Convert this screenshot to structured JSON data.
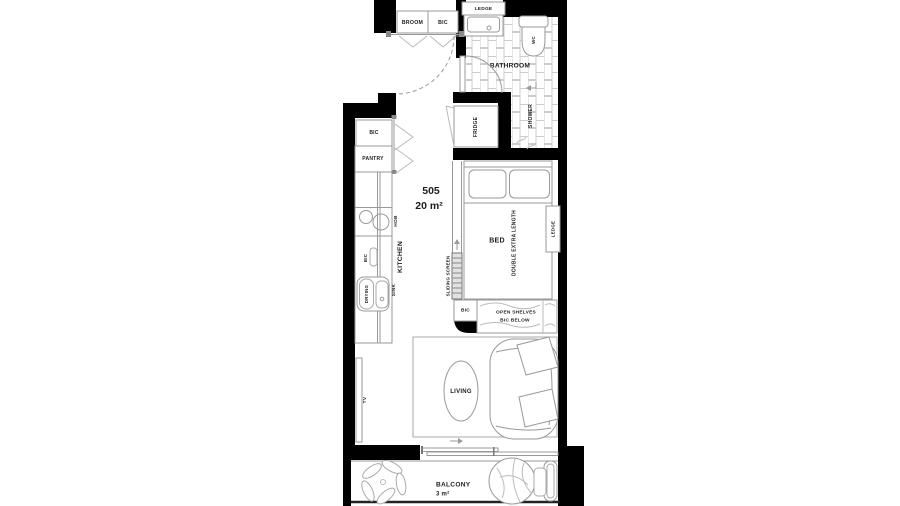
{
  "plan": {
    "unit": {
      "number": "505",
      "area": "20 m²"
    },
    "labels": {
      "broom": "BROOM",
      "bic_entry": "BIC",
      "ledge_bathroom": "LEDGE",
      "wc": "WC",
      "bathroom": "BATHROOM",
      "shower": "SHOWER",
      "fridge": "FRIDGE",
      "bic_kitchen": "BIC",
      "pantry": "PANTRY",
      "hob": "HOB",
      "kitchen": "KITCHEN",
      "bic_counter": "BIC",
      "drying": "DRYING",
      "sink": "SINK",
      "sliding_screen": "SLIDING SCREEN",
      "bed": "BED",
      "bed_size": "DOUBLE EXTRA LENGTH",
      "ledge_bed": "LEDGE",
      "bic_shelf": "BIC",
      "open_shelves_line1": "OPEN SHELVES",
      "open_shelves_line2": "BIC BELOW",
      "living": "LIVING",
      "tv": "TV",
      "balcony": "BALCONY",
      "balcony_area": "3 m²"
    },
    "colors": {
      "wall": "#000000",
      "furniture_line": "#999999",
      "light_line": "#bbbbbb",
      "text": "#1d1d1d",
      "tile_grout": "#cccccc"
    }
  }
}
